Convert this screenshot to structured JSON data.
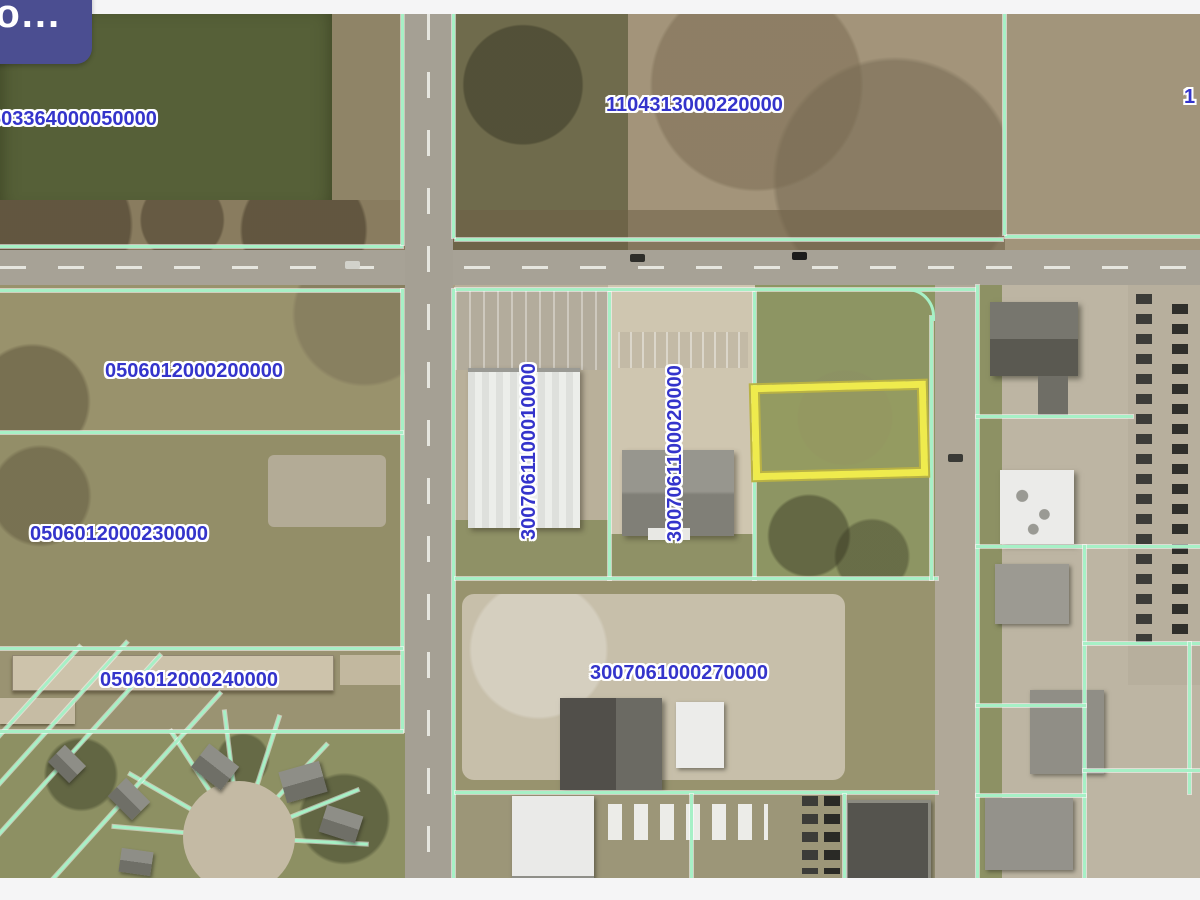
{
  "overlay": {
    "tooltip_label": "to..."
  },
  "map": {
    "parcel_labels": [
      {
        "name": "pond-parcel",
        "text": "603364000050000",
        "orientation": "horizontal"
      },
      {
        "name": "marsh-parcel",
        "text": "1104313000220000",
        "orientation": "horizontal"
      },
      {
        "name": "edge-parcel-partial",
        "text": "1",
        "orientation": "horizontal"
      },
      {
        "name": "field-parcel",
        "text": "0506012000200000",
        "orientation": "horizontal"
      },
      {
        "name": "field-parcel-south",
        "text": "0506012000230000",
        "orientation": "horizontal"
      },
      {
        "name": "warehouse-parcel",
        "text": "0506012000240000",
        "orientation": "horizontal"
      },
      {
        "name": "bigbox-parcel",
        "text": "3007061100010000",
        "orientation": "vertical"
      },
      {
        "name": "office-parcel",
        "text": "3007061100020000",
        "orientation": "vertical"
      },
      {
        "name": "gravel-yard-parcel",
        "text": "3007061000270000",
        "orientation": "horizontal"
      }
    ],
    "highlight": {
      "stroke_color": "#efeb4d"
    },
    "parcel_line_color": "#a7f0c6",
    "label_color": "#3434cb",
    "tooltip_background": "#4b4e91"
  }
}
